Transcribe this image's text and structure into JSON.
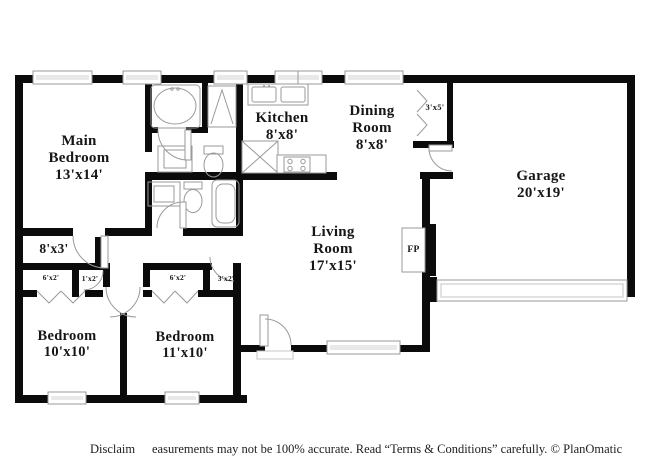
{
  "labels": {
    "main_bedroom": {
      "name": "Main Bedroom",
      "dims": "13'x14'"
    },
    "kitchen": {
      "name": "Kitchen",
      "dims": "8'x8'"
    },
    "dining_room": {
      "name": "Dining Room",
      "dims": "8'x8'"
    },
    "living_room": {
      "name": "Living Room",
      "dims": "17'x15'"
    },
    "garage": {
      "name": "Garage",
      "dims": "20'x19'"
    },
    "bedroom_10": {
      "name": "Bedroom",
      "dims": "10'x10'"
    },
    "bedroom_11": {
      "name": "Bedroom",
      "dims": "11'x10'"
    },
    "hall": {
      "dims": "8'x3'"
    },
    "pantry_closet": {
      "dims": "3'x5'"
    },
    "closet_left_a": {
      "dims": "6'x2'"
    },
    "closet_left_b": {
      "dims": "1'x2'"
    },
    "closet_right_a": {
      "dims": "6'x2'"
    },
    "closet_right_b": {
      "dims": "3'x2'"
    },
    "fireplace": {
      "abbr": "FP"
    }
  },
  "footer": {
    "disclaimer_prefix": "Disclaim",
    "disclaimer_body": "easurements may not be 100% accurate. Read “Terms & Conditions” carefully. © PlanOmatic"
  },
  "colors": {
    "wall": "#0b0b0b",
    "fixture_outline": "#9a9a9a",
    "background": "#ffffff"
  }
}
